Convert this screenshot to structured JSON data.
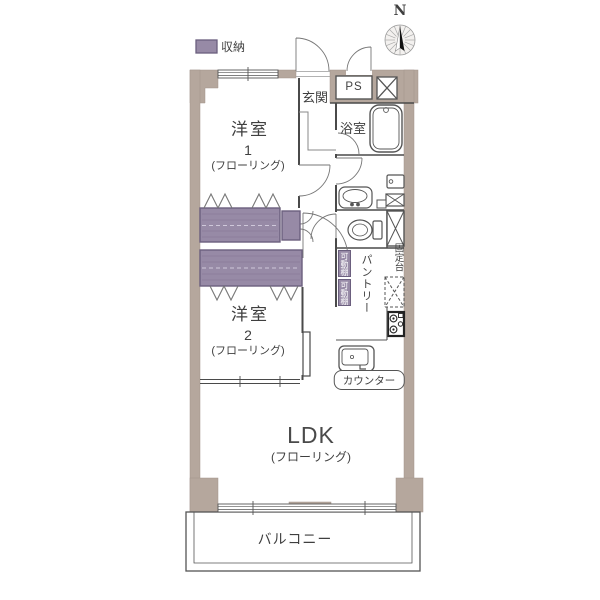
{
  "legend": {
    "label": "収納"
  },
  "compass": {
    "label": "N"
  },
  "rooms": {
    "genkan": {
      "label": "玄関"
    },
    "ps": {
      "label": "PS"
    },
    "bathroom": {
      "label": "浴室"
    },
    "room1": {
      "name": "洋室",
      "number": "1",
      "floor": "(フローリング)"
    },
    "room2": {
      "name": "洋室",
      "number": "2",
      "floor": "(フローリング)"
    },
    "ldk": {
      "label": "LDK",
      "floor": "(フローリング)"
    },
    "balcony": {
      "label": "バルコニー"
    },
    "pantry": {
      "label": "パントリー"
    },
    "kitchen": {
      "counter_label": "カウンター"
    },
    "shelves": {
      "movable1": "可動棚",
      "movable2": "可動棚",
      "fixed": "固定台"
    }
  },
  "colors": {
    "wall": "#b5a79d",
    "storage": "#978aa6",
    "storage-border": "#6b5f7e",
    "line": "#4a4a4a"
  }
}
